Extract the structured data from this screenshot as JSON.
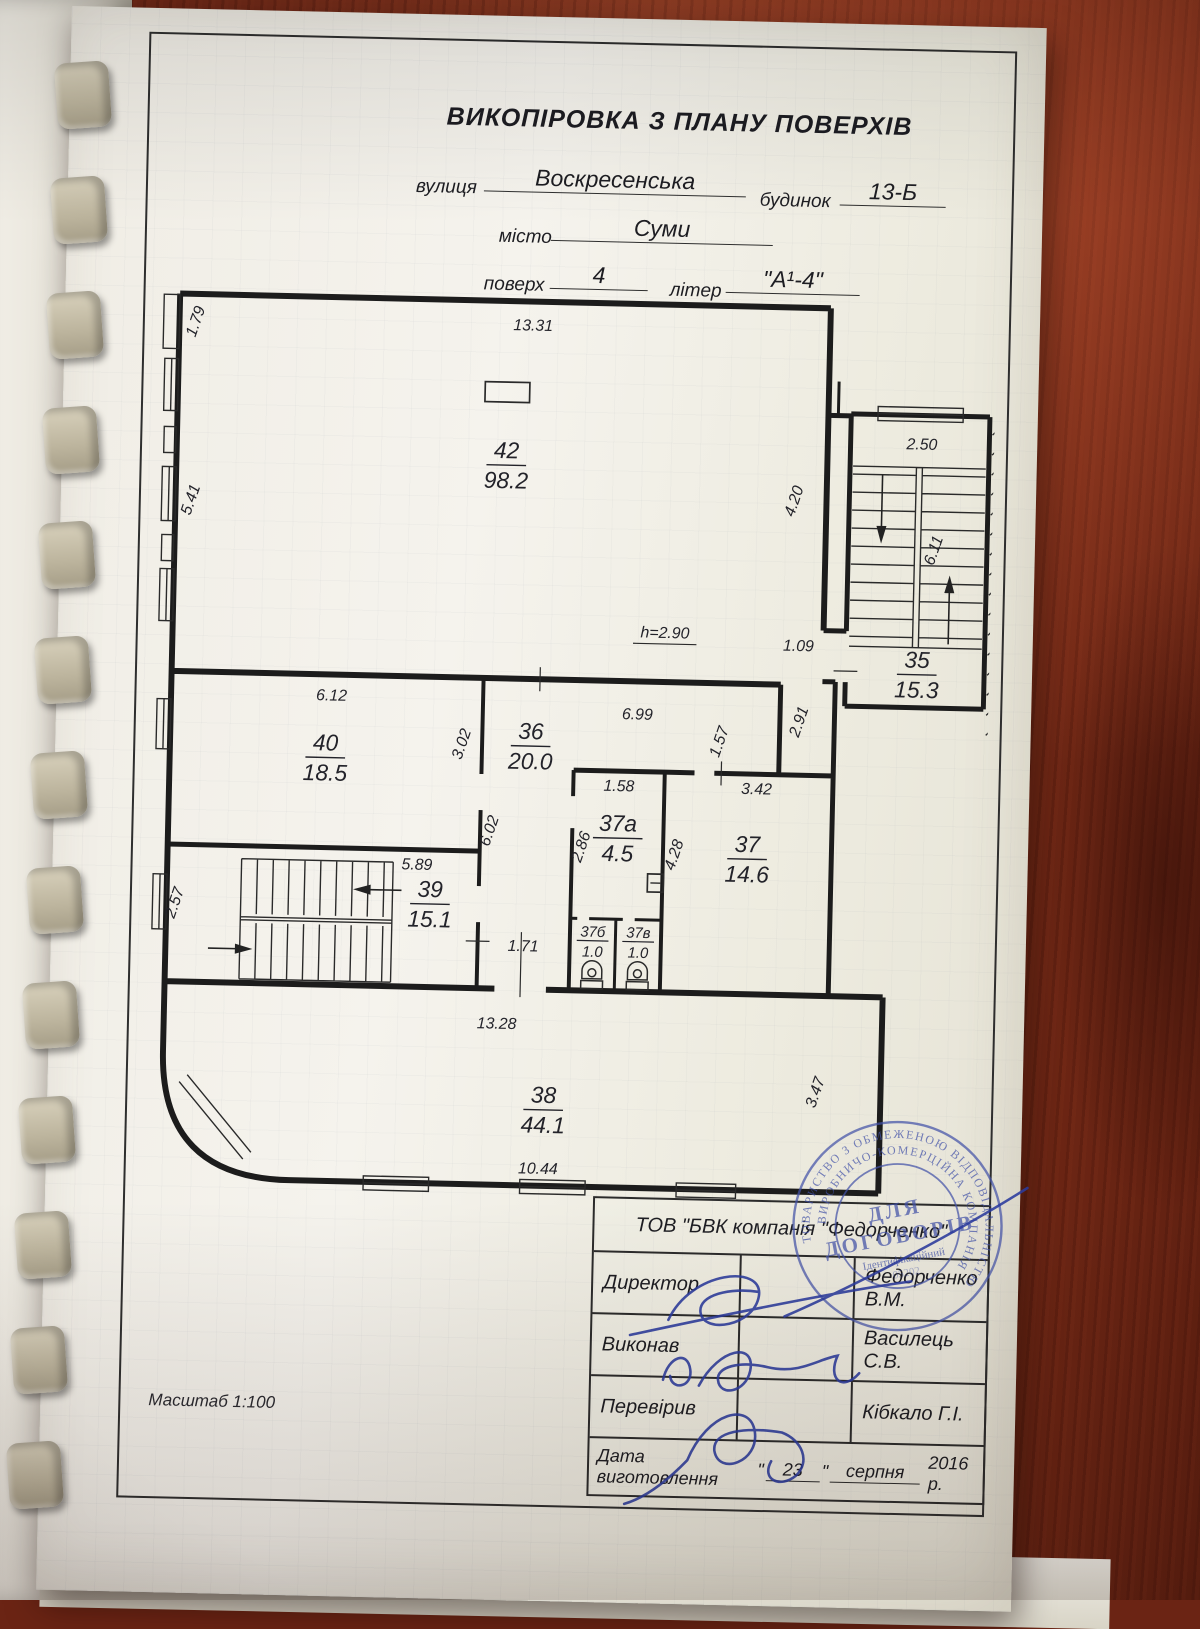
{
  "document": {
    "title": "ВИКОПІРОВКА З ПЛАНУ ПОВЕРХІВ",
    "street_label": "вулиця",
    "street_value": "Воскресенська",
    "building_label": "будинок",
    "building_value": "13-Б",
    "city_label": "місто",
    "city_value": "Суми",
    "floor_label": "поверх",
    "floor_value": "4",
    "letter_label": "літер",
    "letter_value": "\"А¹-4\"",
    "scale_label": "Масштаб 1:100"
  },
  "plan": {
    "rooms": [
      {
        "number": "42",
        "area": "98.2"
      },
      {
        "number": "35",
        "area": "15.3"
      },
      {
        "number": "40",
        "area": "18.5"
      },
      {
        "number": "36",
        "area": "20.0"
      },
      {
        "number": "37а",
        "area": "4.5"
      },
      {
        "number": "37",
        "area": "14.6"
      },
      {
        "number": "37б",
        "area": "1.0"
      },
      {
        "number": "37в",
        "area": "1.0"
      },
      {
        "number": "39",
        "area": "15.1"
      },
      {
        "number": "38",
        "area": "44.1"
      }
    ],
    "dims": {
      "d1331": "13.31",
      "d179": "1.79",
      "d541": "5.41",
      "d420": "4.20",
      "d250": "2.50",
      "d611": "6.11",
      "d109": "1.09",
      "d291": "2.91",
      "h290": "h=2.90",
      "d612": "6.12",
      "d302": "3.02",
      "d699": "6.99",
      "d157": "1.57",
      "d158": "1.58",
      "d286": "2.86",
      "d342": "3.42",
      "d428": "4.28",
      "d589": "5.89",
      "d257": "2.57",
      "d602": "6.02",
      "d171": "1.71",
      "d1328": "13.28",
      "d1044": "10.44",
      "d347": "3.47"
    }
  },
  "stamp": {
    "line1": "ДЛЯ",
    "line2": "ДОГОВОРІВ",
    "sub": "Ідентифікаційний",
    "id_digits": "05202",
    "ring_outer": "ТОВАРИСТВО З ОБМЕЖЕНОЮ ВІДПОВІДАЛЬНІСТЮ",
    "ring_inner": "ВИРОБНИЧО-КОМЕРЦІЙНА КОМПАНІЯ"
  },
  "signature_table": {
    "company": "ТОВ \"БВК компанія \"Федорченко\"",
    "rows": [
      {
        "label": "Директор",
        "name": "Федорченко  В.М."
      },
      {
        "label": "Виконав",
        "name": "Василець С.В."
      },
      {
        "label": "Перевірив",
        "name": "Кібкало Г.І."
      }
    ],
    "date_label": "Дата виготовлення",
    "quote": "\"",
    "date_day": "23",
    "date_month": "серпня",
    "date_year": "2016 р."
  }
}
